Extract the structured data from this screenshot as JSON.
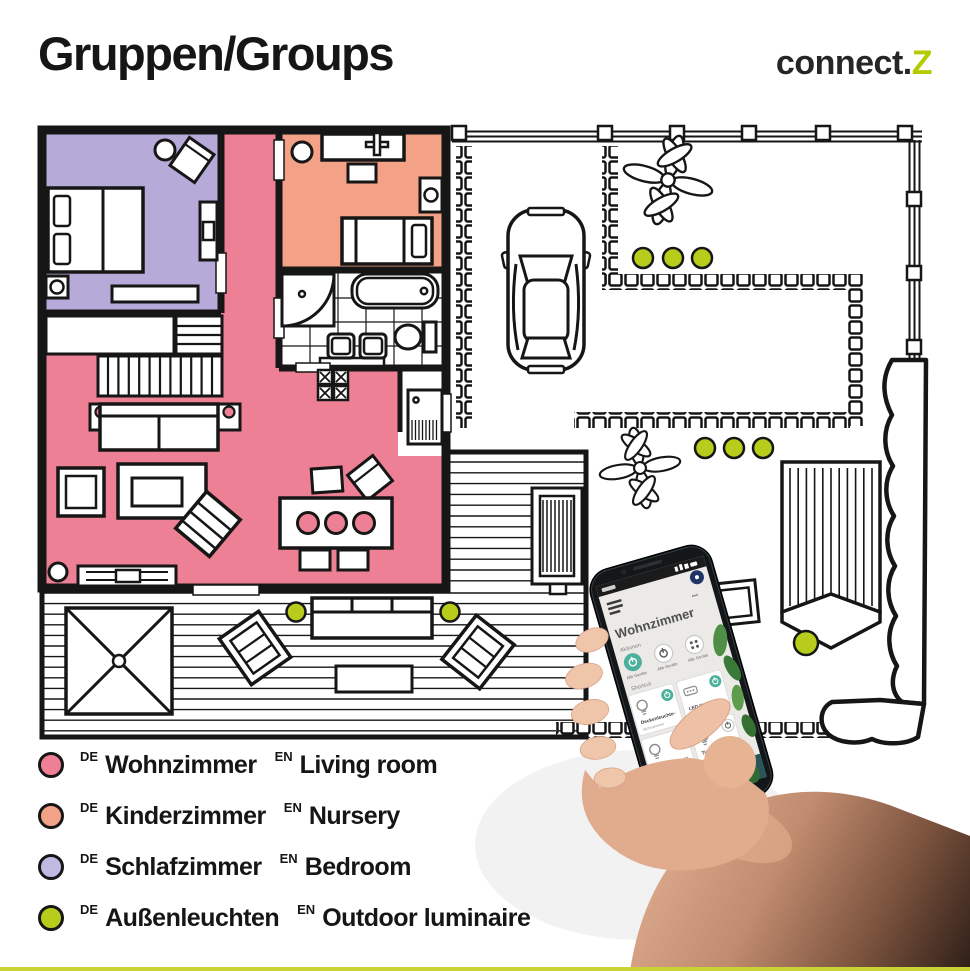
{
  "header": {
    "title": "Gruppen/Groups",
    "brand_prefix": "connect.",
    "brand_suffix": "Z"
  },
  "legend": {
    "items": [
      {
        "lang_de": "DE",
        "name_de": "Wohnzimmer",
        "lang_en": "EN",
        "name_en": "Living room",
        "color": "#ee7f95"
      },
      {
        "lang_de": "DE",
        "name_de": "Kinderzimmer",
        "lang_en": "EN",
        "name_en": "Nursery",
        "color": "#f4a287"
      },
      {
        "lang_de": "DE",
        "name_de": "Schlafzimmer",
        "lang_en": "EN",
        "name_en": "Bedroom",
        "color": "#c0b9e2"
      },
      {
        "lang_de": "DE",
        "name_de": "Außenleuchten",
        "lang_en": "EN",
        "name_en": "Outdoor luminaire",
        "color": "#b8cc1c"
      }
    ]
  },
  "floorplan": {
    "living_room_color": "#ee8095",
    "nursery_color": "#f3a287",
    "bedroom_color": "#b6aad9",
    "outdoor_light_color": "#b8cc1c",
    "wall_color": "#161616"
  },
  "phone": {
    "app": {
      "title": "Wohnzimmer",
      "overflow": "•••",
      "actions_label": "Aktionen",
      "action_button_label": "Alle Geräte",
      "shortcut_label": "Shortcut",
      "accent_color": "#4cb19c",
      "tiles": [
        {
          "name": "Deckenleuchte",
          "room": "Wohnzimmer",
          "more": "•••",
          "state": "on"
        },
        {
          "name": "LED Strip",
          "room": "Wohnzimmer",
          "more": "•••",
          "state": "on"
        },
        {
          "name": "Stehleuchte",
          "room": "Wohnzimmer",
          "more": "•••",
          "state": "on"
        },
        {
          "name": "Tischleuchte",
          "room": "Wohnzimmer",
          "more": "•••",
          "state": "off"
        }
      ]
    }
  },
  "footer": {
    "rule_color": "#c9d434"
  }
}
